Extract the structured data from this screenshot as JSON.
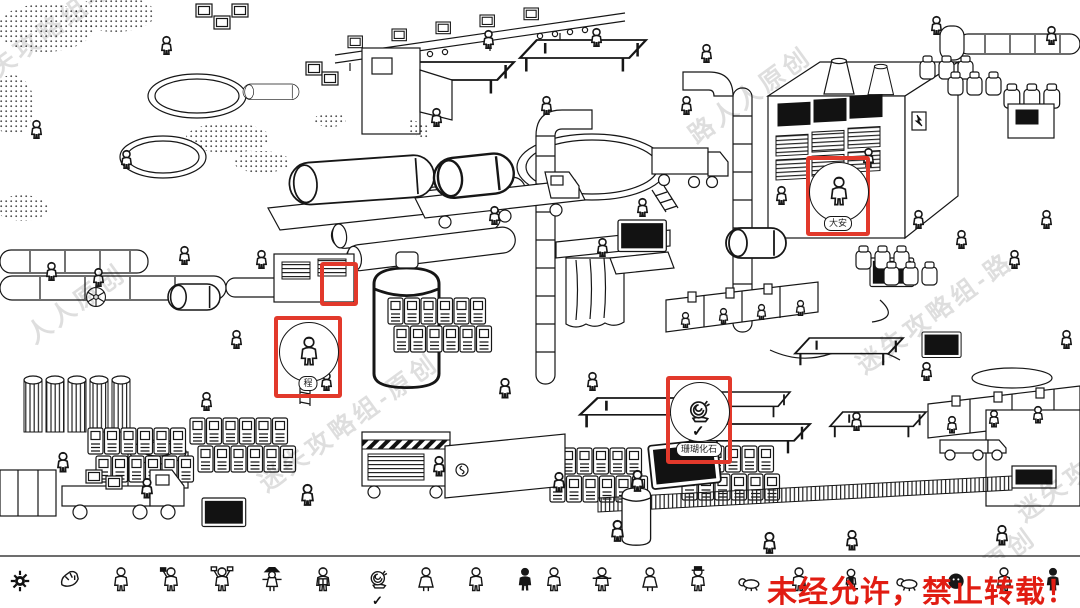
{
  "notice": {
    "text": "未经允许，禁止转载！",
    "color": "#e11c12"
  },
  "watermarks": [
    {
      "text": "迷失攻略组-路",
      "x": -42,
      "y": 72,
      "rot": -36
    },
    {
      "text": "人人原创",
      "x": 18,
      "y": 322,
      "rot": -36
    },
    {
      "text": "迷失攻略组-原创",
      "x": 250,
      "y": 470,
      "rot": -36
    },
    {
      "text": "路人人原创",
      "x": 680,
      "y": 122,
      "rot": -36
    },
    {
      "text": "迷失攻略组-路",
      "x": 848,
      "y": 352,
      "rot": -36
    },
    {
      "text": "人人原创",
      "x": 928,
      "y": 586,
      "rot": -36
    },
    {
      "text": "迷失攻略组",
      "x": 1008,
      "y": 500,
      "rot": -36
    }
  ],
  "highlights": [
    {
      "name": "highlight-valve-wheel",
      "x": 320,
      "y": 262,
      "w": 38,
      "h": 44
    },
    {
      "name": "highlight-worker",
      "x": 274,
      "y": 316,
      "w": 68,
      "h": 82,
      "bubble": "person",
      "label": "程",
      "label_y": 56
    },
    {
      "name": "highlight-da-an",
      "x": 806,
      "y": 156,
      "w": 64,
      "h": 80,
      "bubble": "person",
      "label": "大安",
      "label_y": 56
    },
    {
      "name": "highlight-fossil",
      "x": 666,
      "y": 376,
      "w": 66,
      "h": 88,
      "bubble": "snail",
      "label": "珊瑚化石",
      "label_y": 62,
      "checked": true
    }
  ],
  "bottom_bar": {
    "check": "✓",
    "settings_icon": "gear",
    "items": [
      {
        "x": 57,
        "glyph": "rock",
        "name": "fossil-fragment"
      },
      {
        "x": 108,
        "glyph": "person",
        "name": "worker-with-sash"
      },
      {
        "x": 158,
        "glyph": "person-flag",
        "name": "worker-raising-flag"
      },
      {
        "x": 209,
        "glyph": "arms-up",
        "name": "worker-with-banners"
      },
      {
        "x": 259,
        "glyph": "scarecrow",
        "name": "scarecrow-worker"
      },
      {
        "x": 310,
        "glyph": "reading",
        "name": "worker-reading"
      },
      {
        "x": 366,
        "glyph": "snail",
        "name": "snail-fossil",
        "checked": true
      },
      {
        "x": 413,
        "glyph": "dress",
        "name": "worker-in-apron"
      },
      {
        "x": 463,
        "glyph": "person",
        "name": "worker"
      },
      {
        "x": 512,
        "glyph": "dark",
        "name": "worker-dark-outfit"
      },
      {
        "x": 541,
        "glyph": "person",
        "name": "worker-2"
      },
      {
        "x": 589,
        "glyph": "arms-out",
        "name": "worker-arms-out"
      },
      {
        "x": 637,
        "glyph": "dress",
        "name": "worker-in-dress"
      },
      {
        "x": 685,
        "glyph": "hat",
        "name": "worker-with-hat"
      },
      {
        "x": 736,
        "glyph": "crawler",
        "name": "crawling-worker"
      },
      {
        "x": 786,
        "glyph": "person",
        "name": "worker-3"
      },
      {
        "x": 838,
        "glyph": "sitting",
        "name": "seated-worker"
      },
      {
        "x": 894,
        "glyph": "crawler",
        "name": "lying-worker"
      },
      {
        "x": 943,
        "glyph": "round",
        "name": "round-figure"
      },
      {
        "x": 991,
        "glyph": "person",
        "name": "worker-4"
      },
      {
        "x": 1040,
        "glyph": "dark",
        "name": "worker-dark-2"
      }
    ]
  }
}
